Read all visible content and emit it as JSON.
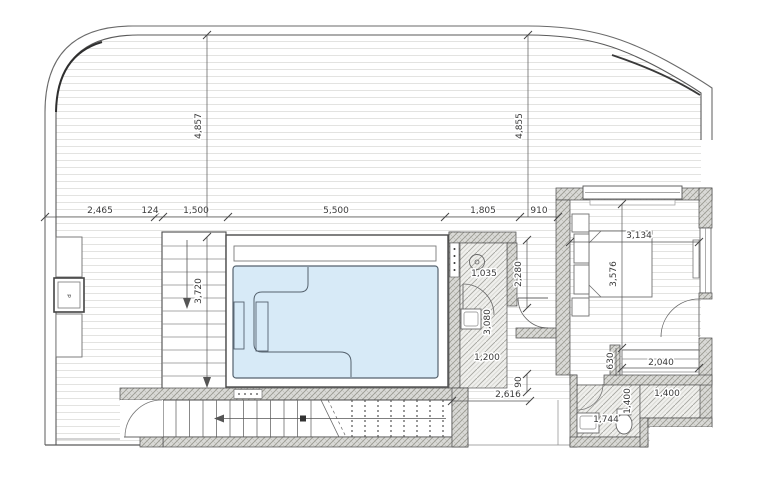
{
  "plan_title": "pool terrace floor plan",
  "colors": {
    "pool_fill": "#d7eaf7",
    "pool_edge": "#55626e",
    "line": "#4a4a4a",
    "deck_line": "#e3e3e1",
    "dim_text": "#3a3a3a"
  },
  "dimensions": {
    "chain_top": [
      "2,465",
      "124",
      "1,500",
      "5,500",
      "1,805",
      "910"
    ],
    "terrace_height_left": "4,857",
    "terrace_height_right": "4,855",
    "stair_run": "3,720",
    "shower": {
      "width_top": "1,035",
      "length": "3,080",
      "width_bottom": "1,200"
    },
    "hall": {
      "height": "2,280",
      "step": "90",
      "length": "2,616"
    },
    "bedroom": {
      "width": "3,134",
      "depth": "3,576",
      "niche_depth": "630",
      "closet_width": "2,040"
    },
    "bathroom": {
      "vanity_width": "1,744",
      "depth": "1,400",
      "width": "1,400"
    }
  },
  "labels": {
    "cabinet": "d"
  }
}
